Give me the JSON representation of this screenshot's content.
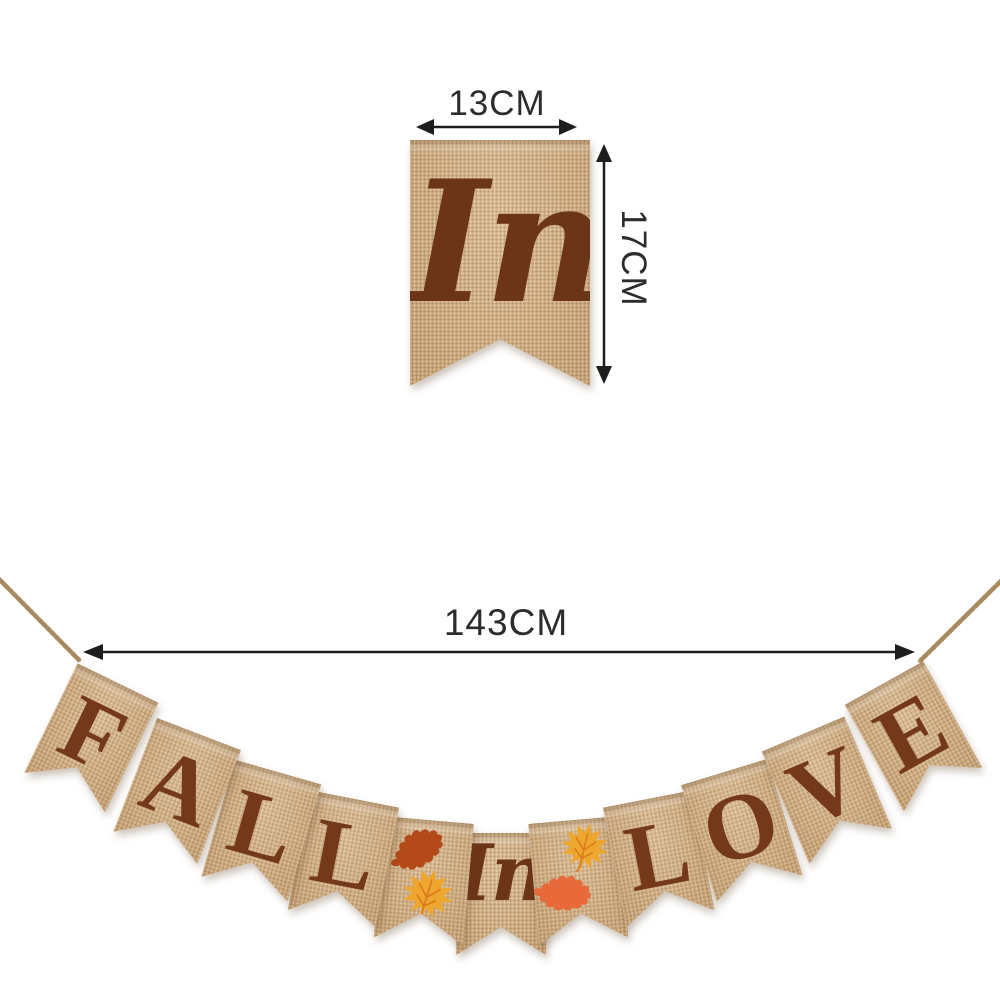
{
  "dimensions": {
    "pennant_width_label": "13CM",
    "pennant_height_label": "17CM",
    "banner_length_label": "143CM"
  },
  "top_detail": {
    "script_text": "In"
  },
  "banner": {
    "phrase": "FALL In LOVE",
    "pennants": [
      {
        "type": "letter",
        "text": "F"
      },
      {
        "type": "letter",
        "text": "A"
      },
      {
        "type": "letter",
        "text": "L"
      },
      {
        "type": "letter",
        "text": "L"
      },
      {
        "type": "leaves",
        "name": "rust-oak-and-gold-maple",
        "leaves": [
          {
            "icon": "oak-leaf",
            "color_key": "oak_rust"
          },
          {
            "icon": "maple-leaf",
            "color_key": "maple_gold"
          }
        ]
      },
      {
        "type": "script",
        "text": "In"
      },
      {
        "type": "leaves",
        "name": "gold-maple-and-orange-oak",
        "leaves": [
          {
            "icon": "maple-leaf",
            "color_key": "maple_gold"
          },
          {
            "icon": "oak-leaf",
            "color_key": "oak_orange"
          }
        ]
      },
      {
        "type": "letter",
        "text": "L"
      },
      {
        "type": "letter",
        "text": "O"
      },
      {
        "type": "letter",
        "text": "V"
      },
      {
        "type": "letter",
        "text": "E"
      }
    ]
  },
  "colors": {
    "background": "#ffffff",
    "burlap": "#d4ae80",
    "letter_brown": "#74391b",
    "script_brown": "#6d3517",
    "oak_rust": "#b44a19",
    "oak_orange": "#e8693a",
    "maple_gold": "#eda62e",
    "maple_vein": "#dd7a1b",
    "dimension_line": "#1d1d1d",
    "dimension_text": "#2c2c2c",
    "twine": "#c0a379",
    "twine_shadow": "#a28257"
  }
}
